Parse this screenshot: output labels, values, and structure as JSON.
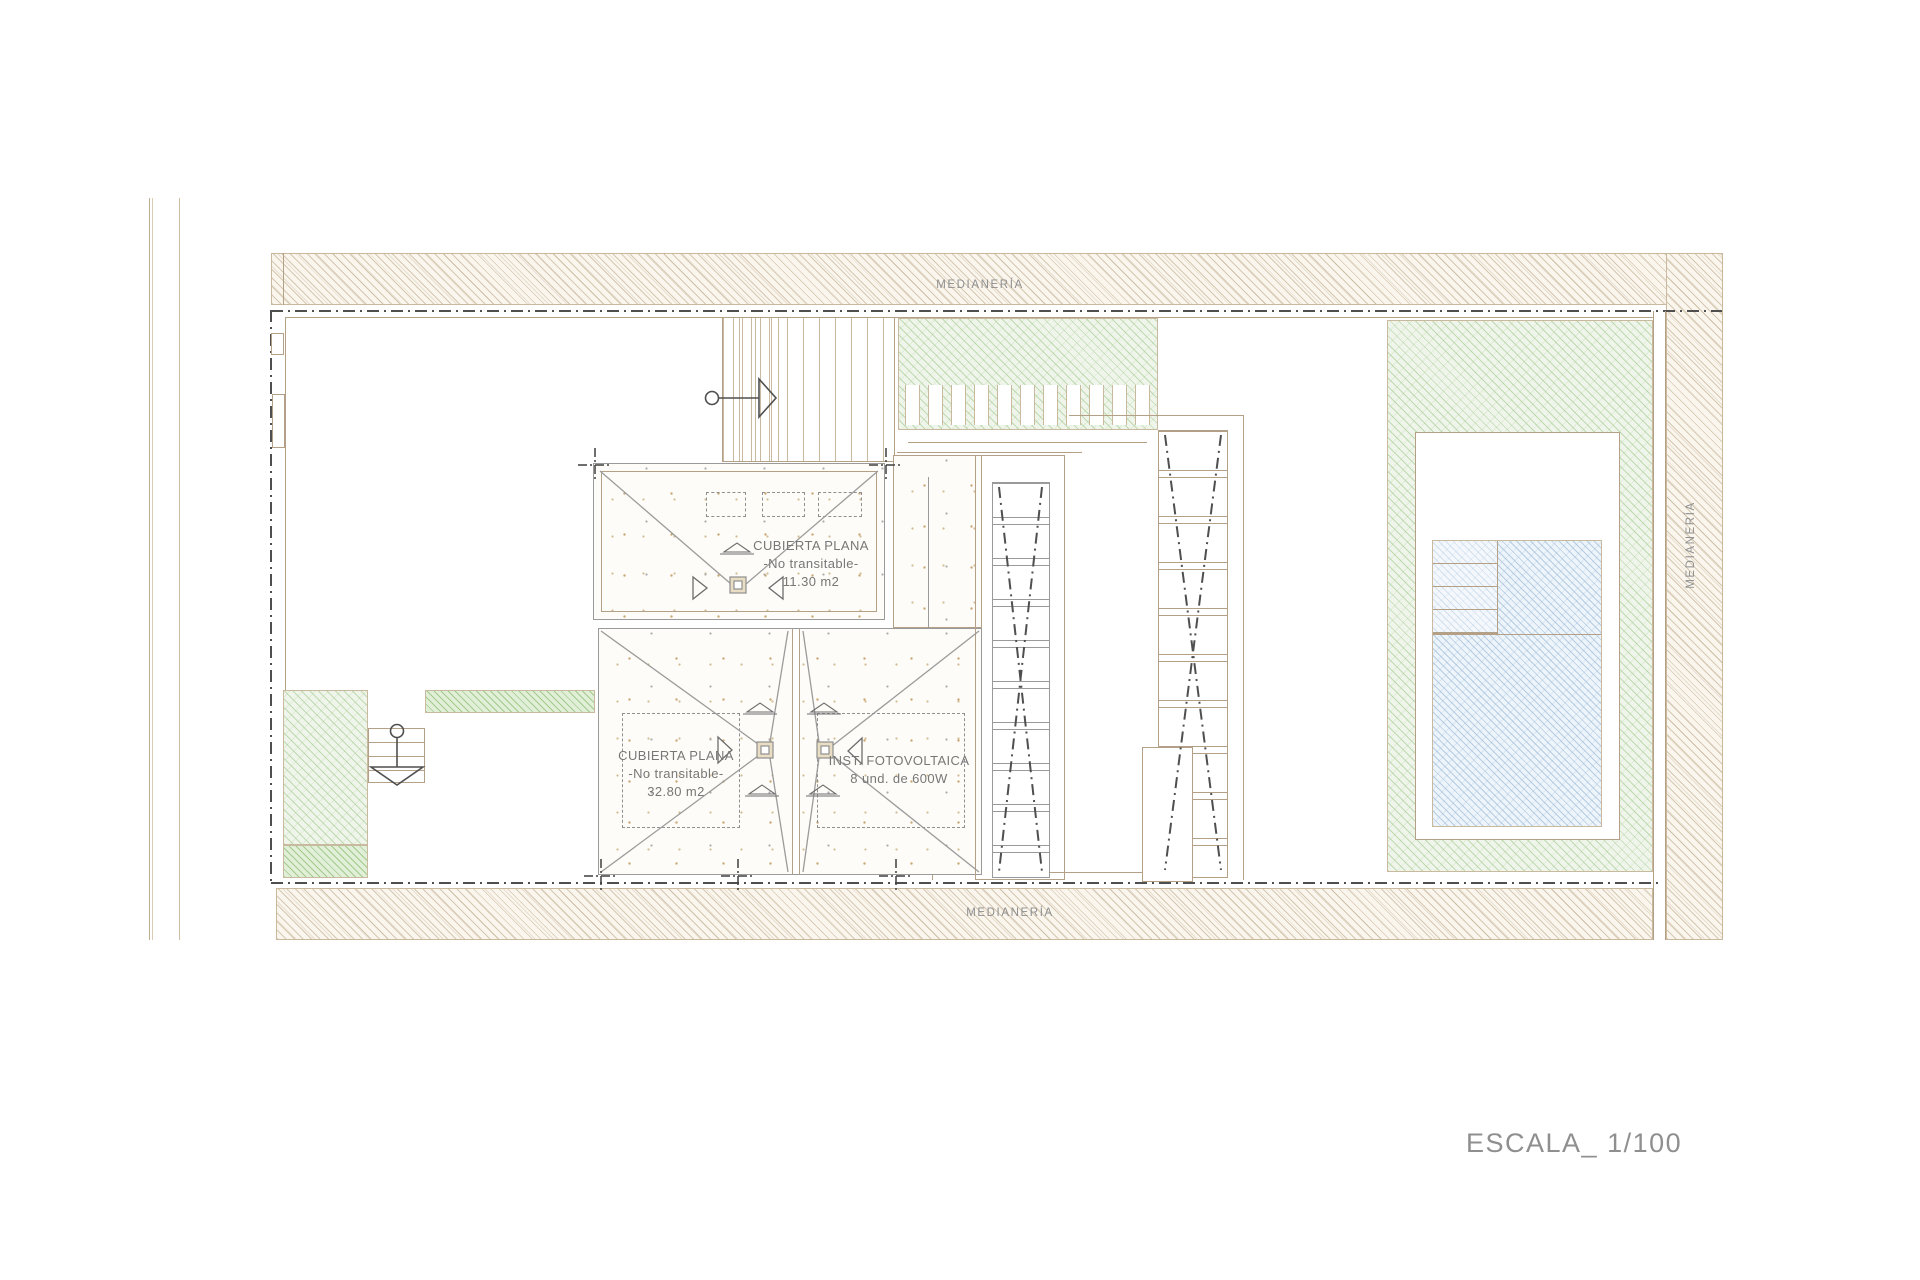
{
  "drawing": {
    "party_wall_label": "MEDIANERÍA",
    "scale_label": "ESCALA_ 1/100",
    "roof_upper": {
      "title": "CUBIERTA PLANA",
      "subtitle": "-No transitable-",
      "area": "11.30 m2"
    },
    "roof_lower": {
      "title": "CUBIERTA PLANA",
      "subtitle": "-No transitable-",
      "area": "32.80 m2"
    },
    "photovoltaic": {
      "title": "INST. FOTOVOLTAICA",
      "detail": "8 und. de 600W"
    }
  },
  "icons": {
    "entry_arrow_right": "entry-arrow-right-icon",
    "entry_arrow_down": "entry-arrow-down-icon",
    "roof_drain": "roof-drain-icon",
    "slope_triangle": "slope-triangle-icon",
    "survey_cross": "survey-cross-icon"
  },
  "colors": {
    "ink": "#4f4f4f",
    "wall": "#b3a087",
    "wall_light": "#c9b99e",
    "gray_line": "#9a9a9a",
    "hatch_tan_bg": "#faf6ee",
    "green_bg": "#eff5ea",
    "green_bright_bg": "#e2efd8",
    "blue_bg": "#edf4fa",
    "text_gray": "#8f8f8f",
    "label_gray": "#777777",
    "drain_fill": "#e9ddc3"
  }
}
